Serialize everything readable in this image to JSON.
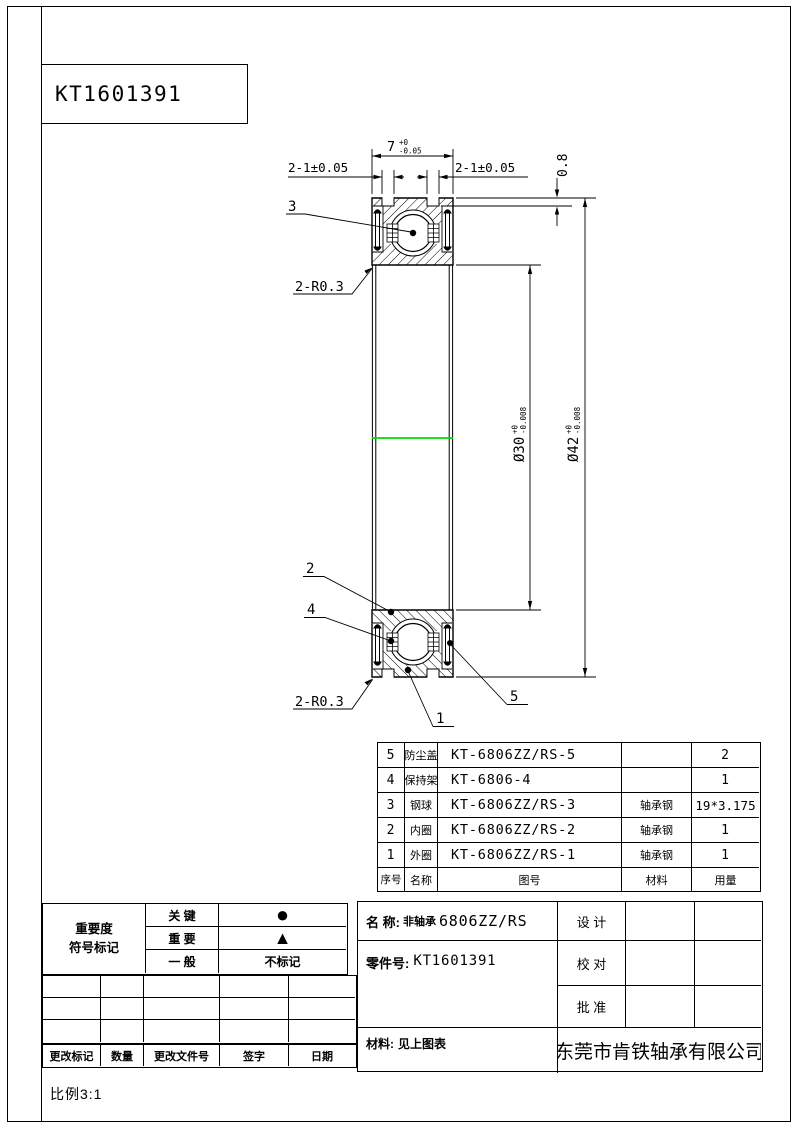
{
  "title_box": {
    "drawing_no": "KT1601391"
  },
  "drawing": {
    "highlight_color": "#00d900",
    "balloons": {
      "b1": "1",
      "b2": "2",
      "b3": "3",
      "b4": "4",
      "b5": "5"
    },
    "dims": {
      "width_main": "7",
      "width_tol_top": "+0",
      "width_tol_bot": "-0.05",
      "groove_left": "2-1±0.05",
      "groove_right": "2-1±0.05",
      "groove_depth": "0.8",
      "fillet_top": "2-R0.3",
      "fillet_bottom": "2-R0.3",
      "bore_main": "Ø30",
      "bore_tol_top": "+0",
      "bore_tol_bot": "-0.008",
      "od_main": "Ø42",
      "od_tol_top": "+0",
      "od_tol_bot": "-0.008"
    }
  },
  "bom": {
    "headers": [
      "序号",
      "名称",
      "图号",
      "材料",
      "用量"
    ],
    "rows": [
      {
        "no": "5",
        "name": "防尘盖",
        "drawing_no": "KT-6806ZZ/RS-5",
        "material": "",
        "qty": "2"
      },
      {
        "no": "4",
        "name": "保持架",
        "drawing_no": "KT-6806-4",
        "material": "",
        "qty": "1"
      },
      {
        "no": "3",
        "name": "钢球",
        "drawing_no": "KT-6806ZZ/RS-3",
        "material": "轴承钢",
        "qty": "19*3.175"
      },
      {
        "no": "2",
        "name": "内圈",
        "drawing_no": "KT-6806ZZ/RS-2",
        "material": "轴承钢",
        "qty": "1"
      },
      {
        "no": "1",
        "name": "外圈",
        "drawing_no": "KT-6806ZZ/RS-1",
        "material": "轴承钢",
        "qty": "1"
      }
    ]
  },
  "title_block": {
    "name_label": "名 称:",
    "name_prefix": "非轴承",
    "name_model": "6806ZZ/RS",
    "part_no_label": "零件号:",
    "part_no_value": "KT1601391",
    "material_label": "材料:",
    "material_value": "见上图表",
    "design": "设 计",
    "check": "校 对",
    "approve": "批 准",
    "company": "东莞市肯铁轴承有限公司"
  },
  "importance": {
    "header_line1": "重要度",
    "header_line2": "符号标记",
    "rows": [
      {
        "label": "关 键",
        "symbol": "●"
      },
      {
        "label": "重 要",
        "symbol": "▲"
      },
      {
        "label": "一 般",
        "symbol": "不标记"
      }
    ]
  },
  "revision": {
    "headers": [
      "更改标记",
      "数量",
      "更改文件号",
      "签字",
      "日期"
    ]
  },
  "scale": {
    "label": "比例3:1"
  }
}
